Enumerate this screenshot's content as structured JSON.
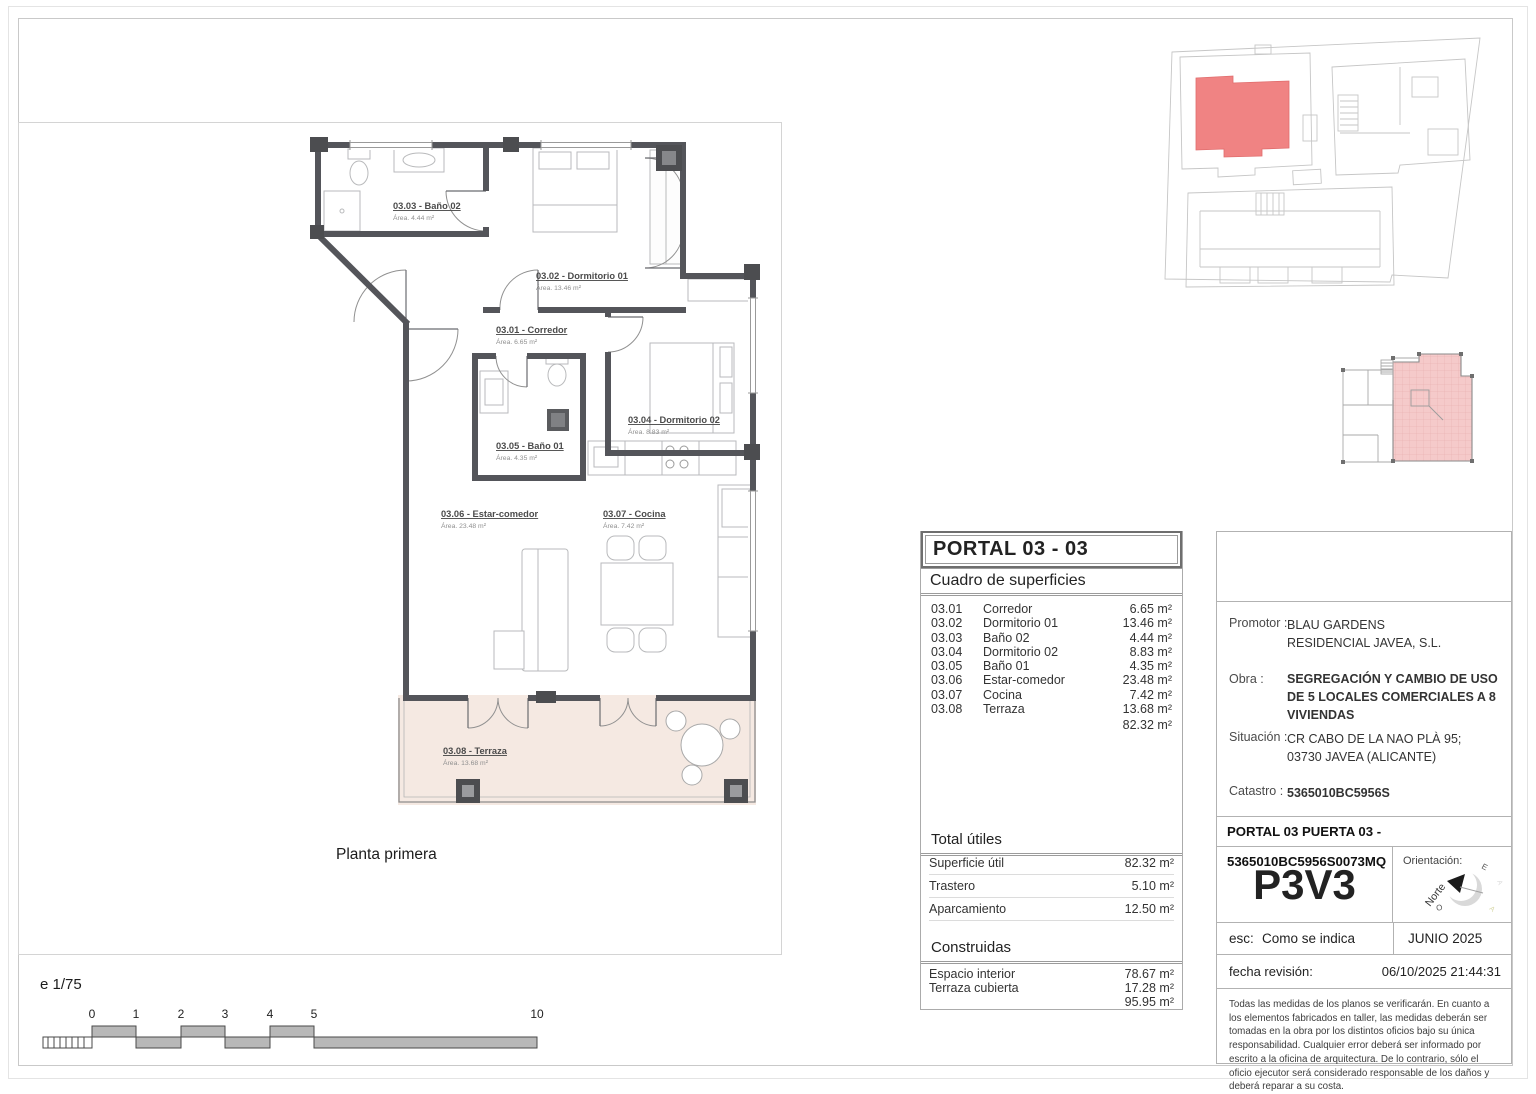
{
  "page": {
    "plan_caption": "Planta primera",
    "scale_caption": "e 1/75"
  },
  "scale_bar": {
    "ticks": [
      "0",
      "1",
      "2",
      "3",
      "4",
      "5",
      "10"
    ]
  },
  "plan": {
    "rooms": [
      {
        "name": "03.01 -  Corredor",
        "area": "Área. 6.65 m²"
      },
      {
        "name": "03.02 -  Dormitorio 01",
        "area": "Área. 13.46 m²"
      },
      {
        "name": "03.03 -  Baño 02",
        "area": "Área. 4.44 m²"
      },
      {
        "name": "03.04 -  Dormitorio 02",
        "area": "Área. 8.83 m²"
      },
      {
        "name": "03.05 -  Baño 01",
        "area": "Área. 4.35 m²"
      },
      {
        "name": "03.06 -  Estar-comedor",
        "area": "Área. 23.48 m²"
      },
      {
        "name": "03.07 -  Cocina",
        "area": "Área. 7.42 m²"
      },
      {
        "name": "03.08 -  Terraza",
        "area": "Área. 13.68 m²"
      }
    ]
  },
  "surfaces_panel": {
    "title": "PORTAL 03 - 03",
    "subtitle": "Cuadro de superficies",
    "rows": [
      {
        "code": "03.01",
        "label": "Corredor",
        "value": "6.65 m²"
      },
      {
        "code": "03.02",
        "label": "Dormitorio 01",
        "value": "13.46 m²"
      },
      {
        "code": "03.03",
        "label": "Baño 02",
        "value": "4.44 m²"
      },
      {
        "code": "03.04",
        "label": "Dormitorio 02",
        "value": "8.83 m²"
      },
      {
        "code": "03.05",
        "label": "Baño 01",
        "value": "4.35 m²"
      },
      {
        "code": "03.06",
        "label": "Estar-comedor",
        "value": "23.48 m²"
      },
      {
        "code": "03.07",
        "label": "Cocina",
        "value": "7.42 m²"
      },
      {
        "code": "03.08",
        "label": "Terraza",
        "value": "13.68 m²"
      }
    ],
    "rows_total": "82.32 m²",
    "utiles_title": "Total útiles",
    "utiles_rows": [
      {
        "label": "Superficie útil",
        "value": "82.32 m²"
      },
      {
        "label": "Trastero",
        "value": "5.10 m²"
      },
      {
        "label": "Aparcamiento",
        "value": "12.50 m²"
      }
    ],
    "built_title": "Construidas",
    "built_rows": [
      {
        "label": "Espacio interior",
        "value": "78.67 m²"
      },
      {
        "label": "Terraza cubierta",
        "value": "17.28 m²"
      }
    ],
    "built_total": "95.95 m²"
  },
  "title_block": {
    "promoter_label": "Promotor :",
    "promoter_value": "BLAU GARDENS RESIDENCIAL JAVEA, S.L.",
    "work_label": "Obra :",
    "work_value": "SEGREGACIÓN Y CAMBIO DE USO DE 5 LOCALES COMERCIALES A 8 VIVIENDAS",
    "location_label": "Situación :",
    "location_value": "CR CABO DE LA NAO PLÀ 95; 03730 JAVEA (ALICANTE)",
    "cadastre_label": "Catastro :",
    "cadastre_value": "5365010BC5956S",
    "unit_line": "PORTAL 03 PUERTA 03 - 5365010BC5956S0073MQ",
    "unit_code": "P3V3",
    "orientation_label": "Orientación:",
    "compass_north": "Norte",
    "compass_e": "E",
    "compass_o": "O",
    "compass_faint": "A",
    "scale_label": "esc:",
    "scale_value": "Como se indica",
    "date_value": "JUNIO 2025",
    "revision_label": "fecha revisión:",
    "revision_value": "06/10/2025 21:44:31",
    "disclaimer": "Todas las medidas de los planos se verificarán. En cuanto a los elementos fabricados en taller, las medidas deberán ser tomadas en la obra por los distintos oficios bajo su única responsabilidad. Cualquier error deberá ser informado por escrito a la oficina de arquitectura. De lo contrario, sólo el oficio ejecutor será considerado responsable de los daños y deberá reparar a su costa.",
    "accent_red": "#f08383",
    "accent_pink": "#f5caca"
  }
}
